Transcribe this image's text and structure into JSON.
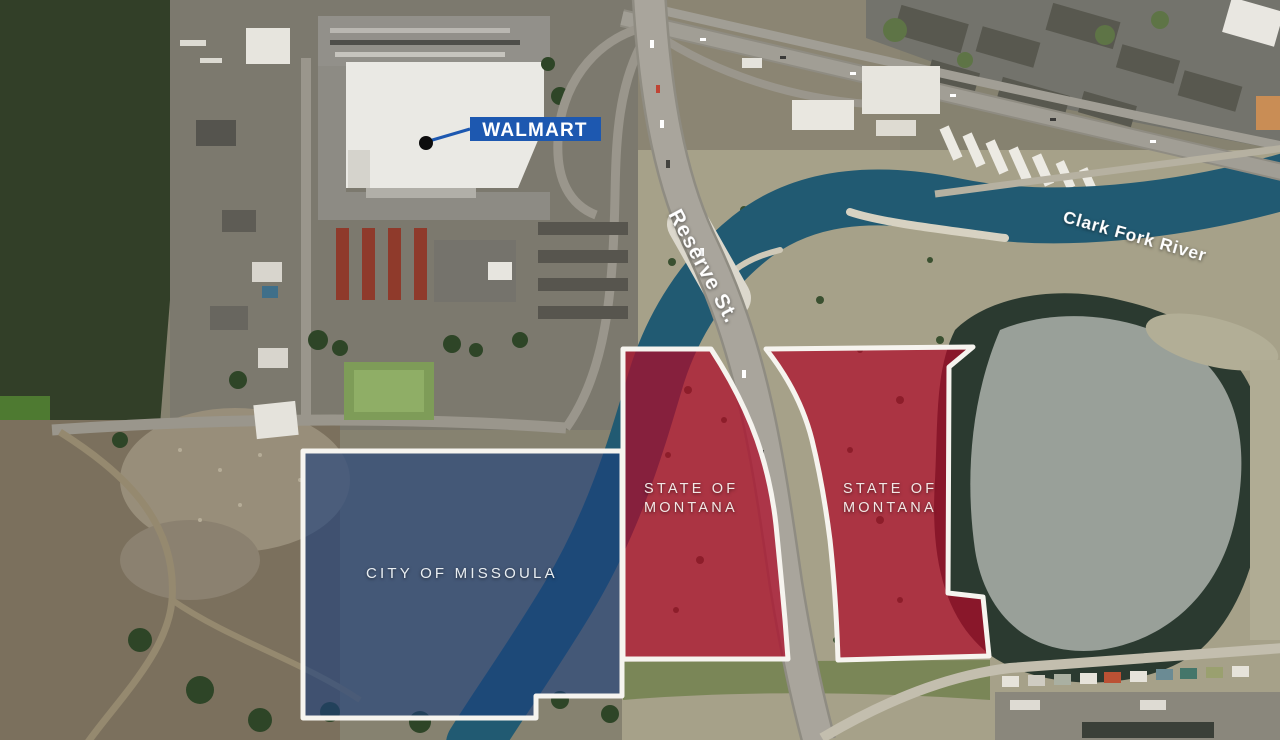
{
  "graphic": {
    "description": "Aerial news map of the Reserve St. area in Missoula showing land ownership parcels"
  },
  "annotations": {
    "walmart": {
      "label": "WALMART",
      "box_color": "#1d58b0",
      "text_color": "#ffffff",
      "dot_color": "#0d0d0d"
    },
    "streets": {
      "reserve": "Reserve St."
    },
    "water": {
      "river": "Clark Fork River",
      "river_color": "#215a72"
    }
  },
  "parcels": {
    "city": {
      "owner": "CITY OF MISSOULA",
      "fill": "#1c3f7d",
      "outline": "#f6f4ef",
      "text_color": "#e9eef2"
    },
    "state_west": {
      "line1": "STATE OF",
      "line2": "MONTANA",
      "fill": "#ad0a28",
      "outline": "#f6f4ef",
      "text_color": "#f2e7e5"
    },
    "state_east": {
      "line1": "STATE OF",
      "line2": "MONTANA",
      "fill": "#ad0a28",
      "outline": "#f6f4ef",
      "text_color": "#f2e7e5"
    }
  }
}
